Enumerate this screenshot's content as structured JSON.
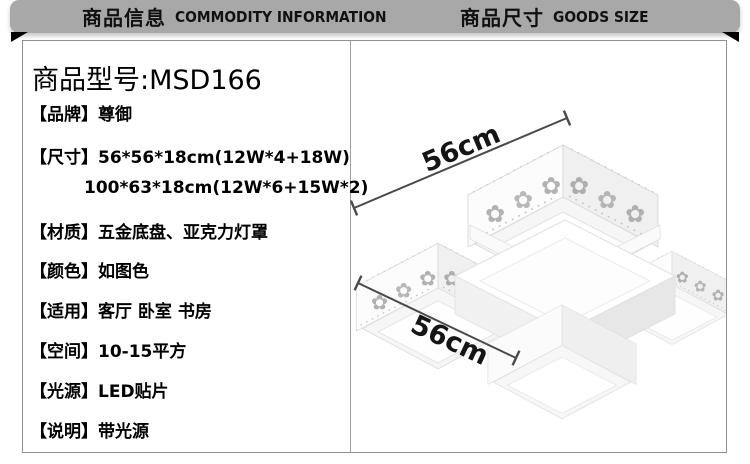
{
  "header": {
    "left": {
      "cn": "商品信息",
      "en": "COMMODITY INFORMATION"
    },
    "right": {
      "cn": "商品尺寸",
      "en": "GOODS SIZE"
    }
  },
  "product": {
    "model_line": "商品型号:MSD166",
    "specs": [
      {
        "label": "【品牌】",
        "value": "尊御"
      },
      {
        "label": "【尺寸】",
        "value": "56*56*18cm(12W*4+18W)",
        "value2": "100*63*18cm(12W*6+15W*2)"
      },
      {
        "label": "【材质】",
        "value": "五金底盘、亚克力灯罩"
      },
      {
        "label": "【颜色】",
        "value": "如图色"
      },
      {
        "label": "【适用】",
        "value": "客厅 卧室 书房"
      },
      {
        "label": "【空间】",
        "value": "10-15平方"
      },
      {
        "label": "【光源】",
        "value": "LED贴片"
      },
      {
        "label": "【说明】",
        "value": "带光源"
      }
    ]
  },
  "size_panel": {
    "dim_top": "56cm",
    "dim_bottom": "56cm"
  },
  "colors": {
    "ribbon": "#a8a8a8",
    "header_text": "#111111",
    "body_text": "#000000",
    "dim_line": "#4a4a4a",
    "box_border": "#909090"
  }
}
